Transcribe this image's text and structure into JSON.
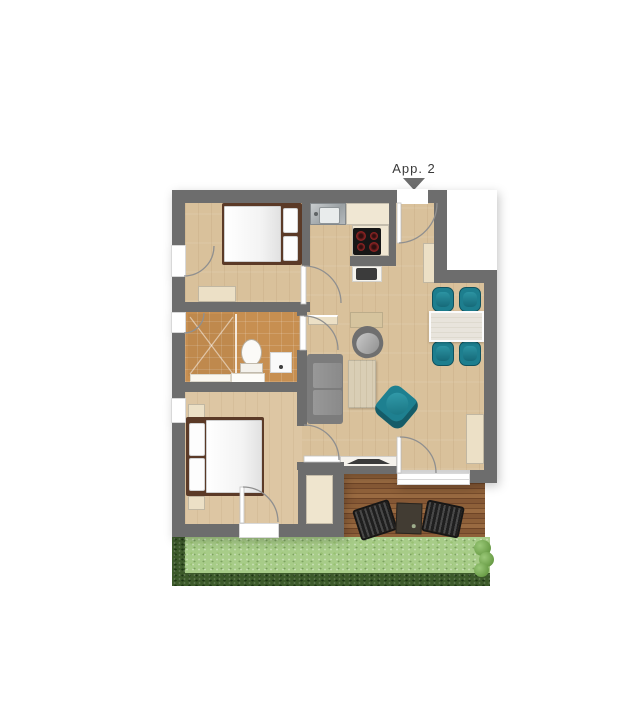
{
  "apartment": {
    "label": "App. 2"
  },
  "entrance_marker": {
    "shape": "triangle-down",
    "color": "#6d6d6d"
  },
  "rooms": [
    {
      "name": "bedroom-top",
      "furniture": [
        "double-bed",
        "pillows",
        "sideboard",
        "french-window"
      ]
    },
    {
      "name": "kitchen",
      "furniture": [
        "sink-unit",
        "counter",
        "cooktop-4-burners",
        "coffee-machine",
        "tall-cabinet"
      ]
    },
    {
      "name": "hallway",
      "furniture": [
        "entrance-door",
        "wardrobe-cabinet"
      ]
    },
    {
      "name": "dining-area",
      "furniture": [
        "dining-table",
        "chair",
        "chair",
        "chair",
        "chair",
        "sideboard"
      ]
    },
    {
      "name": "living-area",
      "furniture": [
        "sofa",
        "coffee-table",
        "desk",
        "desk-chair",
        "armchair",
        "tv-lowboard",
        "tv",
        "wall-shelf",
        "closet-niche",
        "terrace-door"
      ]
    },
    {
      "name": "bathroom",
      "furniture": [
        "shower",
        "glass-divider",
        "toilet",
        "washing-machine",
        "vanity",
        "bath-mat",
        "window"
      ]
    },
    {
      "name": "bedroom-bottom",
      "furniture": [
        "double-bed",
        "pillows",
        "nightstand",
        "nightstand",
        "garden-door",
        "window"
      ]
    },
    {
      "name": "terrace",
      "furniture": [
        "deck",
        "lounger",
        "lounger",
        "side-table"
      ]
    }
  ],
  "garden": {
    "elements": [
      "lawn",
      "hedge-left",
      "hedge-bottom",
      "bushes-right"
    ]
  },
  "colors": {
    "wall": "#6d6d6d",
    "floor_wood": "#d9c19b",
    "floor_tile": "#c78f51",
    "furniture_cream": "#ece0c6",
    "accent_teal": "#1d7e8e",
    "sofa_gray": "#8b8b8b",
    "bed_frame_brown": "#5b3a27",
    "deck_brown": "#85552f",
    "lawn_green": "#a7cc88",
    "hedge_green": "#3c5a2a",
    "label_text": "#3a3a3a"
  }
}
